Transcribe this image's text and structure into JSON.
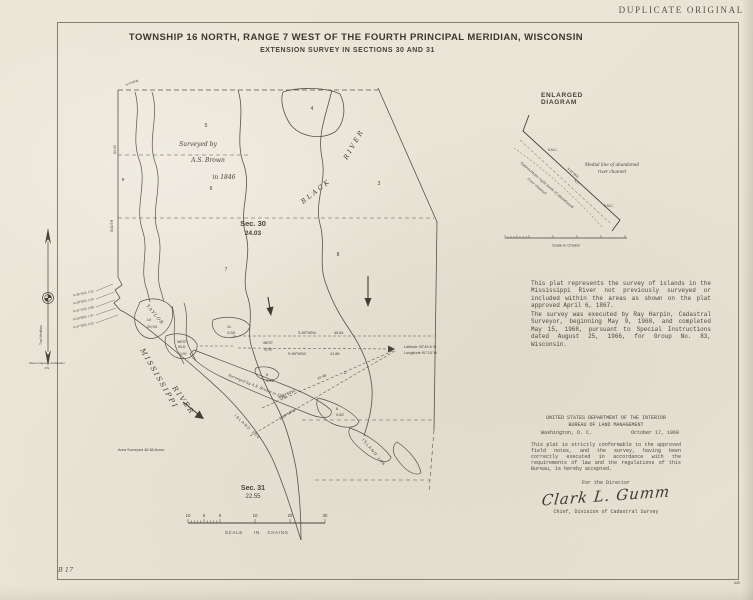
{
  "colors": {
    "paper": "#e9e4d6",
    "ink": "#45423a",
    "border": "#837f6e"
  },
  "stamp": "DUPLICATE ORIGINAL",
  "title": "TOWNSHIP 16 NORTH, RANGE 7 WEST OF THE FOURTH PRINCIPAL MERIDIAN, WISCONSIN",
  "subtitle": "EXTENSION SURVEY IN SECTIONS 30 AND 31",
  "map": {
    "surveyed1": "Surveyed  by",
    "surveyed2": "A.S. Brown",
    "surveyed3": "in 1846",
    "sec30": "Sec. 30",
    "sec30_area": "24.03",
    "sec31": "Sec. 31",
    "sec31_area": "22.55",
    "black": "BLACK",
    "black_river": "RIVER",
    "miss": "MISSISSIPPI",
    "miss_river": "RIVER",
    "taylor": "TAYLOR",
    "taylor_lot": "10",
    "taylor_area": "20.94",
    "lots": [
      "4",
      "5",
      "9",
      "6",
      "3",
      "7",
      "8",
      "1"
    ],
    "islands": {
      "i11": "11",
      "i11_area": "3.58",
      "west1": "WEST",
      "west1b": "ISLD.",
      "west1_area": "0.90",
      "west2": "WEST",
      "west2_dist": "26.60",
      "i5": "5",
      "i5_area": "0.48",
      "i8": "8",
      "i8_area": "0.82",
      "island105": "ISLAND 105",
      "island106": "ISLAND 106",
      "note": "Surveyed by A.S. Brown in 1849"
    },
    "fan": {
      "b1": "S.89°58'W.",
      "d1": "45.84",
      "b2": "S.89°56'W.",
      "d2": "41.88",
      "b3": "S.89°58'W.",
      "d3": "47.46",
      "b4": "S.89°59'W."
    },
    "latitude": "Latitude 43°49.6' N",
    "longitude": "Longitude 91°15' W",
    "meanders": [
      "N.36°45'E. 2.31",
      "N.29°30'E. 1.64",
      "N.41°15'E. 2.08",
      "N.33°00'E. 1.87",
      "N.47°30'E. 2.52"
    ],
    "edge": {
      "dist": "64.43",
      "south": "SOUTH",
      "corner": "N.0°03'W."
    },
    "area_surveyed": "Area Surveyed  46.58 Acres",
    "compass": {
      "meridian": "True Meridian",
      "decl1": "Mean magnetic declination",
      "decl2": "4°E"
    },
    "scale": {
      "t0": "10",
      "t1": "5",
      "t2": "0",
      "t3": "10",
      "t4": "20",
      "t5": "30",
      "w1": "SCALE",
      "w2": "IN",
      "w3": "CHAINS"
    }
  },
  "diagram": {
    "heading": "ENLARGED  DIAGRAM",
    "smc1": "S.M.C.",
    "smc2": "S.M.C.",
    "bearing": "S.42°45'E.",
    "distance": "4.27",
    "medial1": "Medial line of abandoned",
    "medial2": "river channel",
    "bank1": "Approximate right bank of abandoned",
    "bank2": "river channel",
    "scale_label": "Scale in Chains"
  },
  "notes": {
    "para1": "This plat represents the survey of islands in the Mississippi River not previously surveyed or included within the areas as shown on the plat approved April 6, 1867.",
    "para2": "The survey was executed by Ray Harpin, Cadastral Surveyor, beginning May 9, 1968, and completed May 15, 1968, pursuant to Special Instructions dated August 25, 1966, for Group No. 83, Wisconsin."
  },
  "cert": {
    "dept1": "UNITED STATES DEPARTMENT OF THE INTERIOR",
    "dept2": "BUREAU OF LAND MANAGEMENT",
    "location": "Washington, D. C.",
    "date": "October 17, 1969",
    "body": "This plat is strictly conformable to the approved field notes, and the survey, having been correctly executed in accordance with the requirements of law and the regulations of this Bureau, is hereby accepted.",
    "for_director": "For the Director",
    "signature": "Clark L. Gumm",
    "chief": "Chief, Division of Cadastral Survey"
  },
  "marks": {
    "bl": "B 17",
    "br": "440"
  }
}
